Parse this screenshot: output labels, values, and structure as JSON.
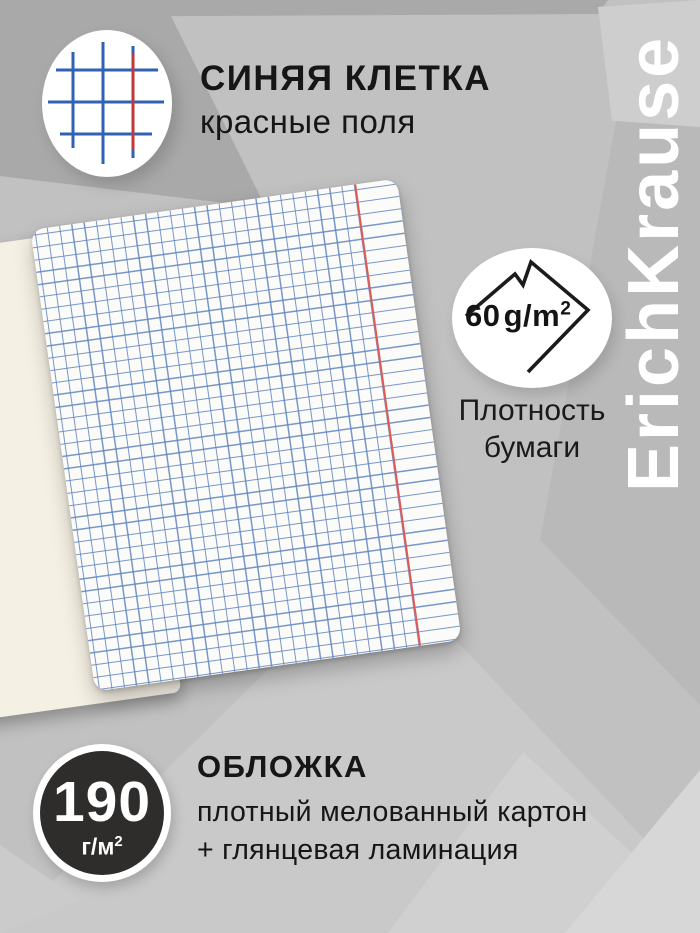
{
  "header": {
    "title": "СИНЯЯ КЛЕТКА",
    "subtitle": "красные поля"
  },
  "brand": {
    "name": "ErichKrause"
  },
  "paper": {
    "weight_value": "60",
    "weight_unit": "g/m",
    "weight_sup": "2",
    "label_line1": "Плотность",
    "label_line2": "бумаги"
  },
  "cover": {
    "weight_value": "190",
    "weight_unit": "г/м",
    "weight_sup": "2",
    "heading": "ОБЛОЖКА",
    "line1": "плотный мелованный картон",
    "line2": "+ глянцевая ламинация"
  },
  "icons": {
    "grid_icon": "blue-grid-with-red-margin",
    "sheet_icon": "paper-sheet-folded-corner"
  },
  "colors": {
    "bg_base": "#c1c1c1",
    "grid_blue": "#6185bd",
    "margin_red": "#e05a55",
    "icon_blue": "#2f62b5",
    "icon_red": "#bf3a3a",
    "badge_dark": "#2e2d2c",
    "cover_cream": "#f5f0e4",
    "brand_white": "#ffffff",
    "text_dark": "#161616"
  }
}
